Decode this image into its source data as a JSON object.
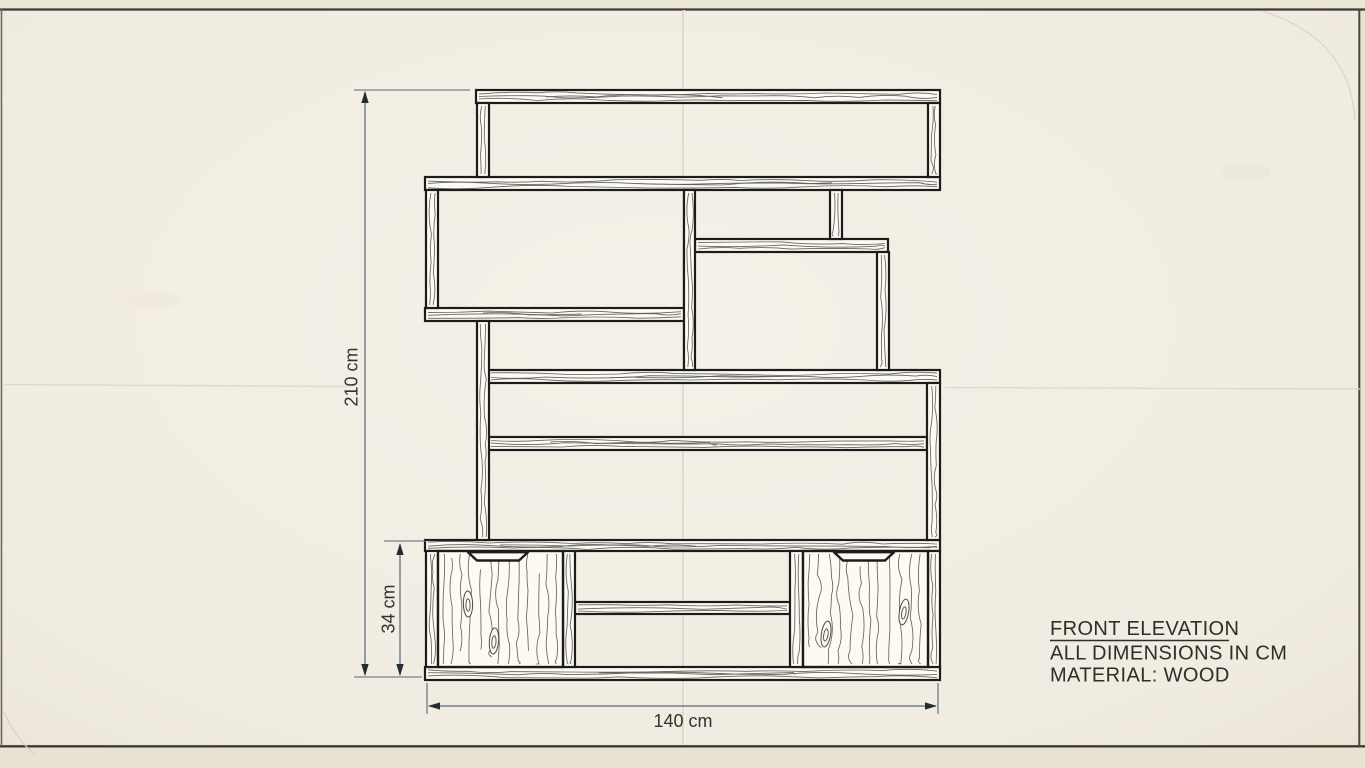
{
  "title_block": {
    "title": "FRONT ELEVATION",
    "note_units": "ALL DIMENSIONS IN CM",
    "note_material": "MATERIAL: WOOD"
  },
  "dimension_labels": {
    "overall_height": "210 cm",
    "cabinet_height": "34 cm",
    "overall_width": "140 cm"
  },
  "colors": {
    "paper": "#f0ebdf",
    "paper_edge": "#e9e2d1",
    "crease": "#dcd5c6",
    "board_fill": "#fcfaf3",
    "outline": "#1c1c1a",
    "grain": "#4a4942",
    "dimension_line": "#5a6673",
    "dimension_arrow": "#232b34",
    "text": "#2e2d29"
  },
  "drawing": {
    "boards": [
      {
        "name": "top-shelf-board",
        "x": 476,
        "y": 90,
        "w": 464,
        "h": 13
      },
      {
        "name": "upper-shelf-board",
        "x": 425,
        "y": 177,
        "w": 515,
        "h": 13
      },
      {
        "name": "right-small-shelf-board",
        "x": 695,
        "y": 239,
        "w": 193,
        "h": 13
      },
      {
        "name": "left-mid-shelf-board",
        "x": 425,
        "y": 308,
        "w": 259,
        "h": 13
      },
      {
        "name": "long-mid-shelf-board",
        "x": 488,
        "y": 370,
        "w": 452,
        "h": 13
      },
      {
        "name": "lower-shelf-board",
        "x": 488,
        "y": 437,
        "w": 439,
        "h": 13
      },
      {
        "name": "cabinet-top-board",
        "x": 425,
        "y": 540,
        "w": 515,
        "h": 11
      },
      {
        "name": "cabinet-bottom-board",
        "x": 425,
        "y": 667,
        "w": 515,
        "h": 13
      },
      {
        "name": "compartment-shelf-board",
        "x": 575,
        "y": 602,
        "w": 215,
        "h": 12
      }
    ],
    "posts": [
      {
        "name": "post-top-left",
        "x": 477,
        "y": 103,
        "w": 12,
        "h": 74
      },
      {
        "name": "post-top-right",
        "x": 928,
        "y": 103,
        "w": 12,
        "h": 74
      },
      {
        "name": "post-upper-left",
        "x": 426,
        "y": 190,
        "w": 12,
        "h": 118
      },
      {
        "name": "post-middle",
        "x": 684,
        "y": 190,
        "w": 11,
        "h": 180
      },
      {
        "name": "post-small-shelf-left",
        "x": 830,
        "y": 190,
        "w": 12,
        "h": 49
      },
      {
        "name": "post-small-shelf-right",
        "x": 877,
        "y": 252,
        "w": 12,
        "h": 118
      },
      {
        "name": "post-lower-left",
        "x": 477,
        "y": 321,
        "w": 12,
        "h": 219
      },
      {
        "name": "post-lower-right",
        "x": 927,
        "y": 383,
        "w": 13,
        "h": 157
      },
      {
        "name": "cabinet-side-left",
        "x": 426,
        "y": 551,
        "w": 12,
        "h": 116
      },
      {
        "name": "cabinet-divider-left",
        "x": 563,
        "y": 551,
        "w": 12,
        "h": 116
      },
      {
        "name": "cabinet-divider-right",
        "x": 790,
        "y": 551,
        "w": 13,
        "h": 116
      },
      {
        "name": "cabinet-side-right",
        "x": 928,
        "y": 551,
        "w": 12,
        "h": 116
      }
    ],
    "doors": [
      {
        "name": "cabinet-door-left",
        "x": 438,
        "y": 551,
        "w": 125,
        "h": 116,
        "notch_cx": 498,
        "knots": [
          [
            468,
            604
          ],
          [
            494,
            641
          ]
        ]
      },
      {
        "name": "cabinet-door-right",
        "x": 803,
        "y": 551,
        "w": 125,
        "h": 116,
        "notch_cx": 864,
        "knots": [
          [
            826,
            634
          ],
          [
            904,
            612
          ]
        ]
      }
    ]
  }
}
